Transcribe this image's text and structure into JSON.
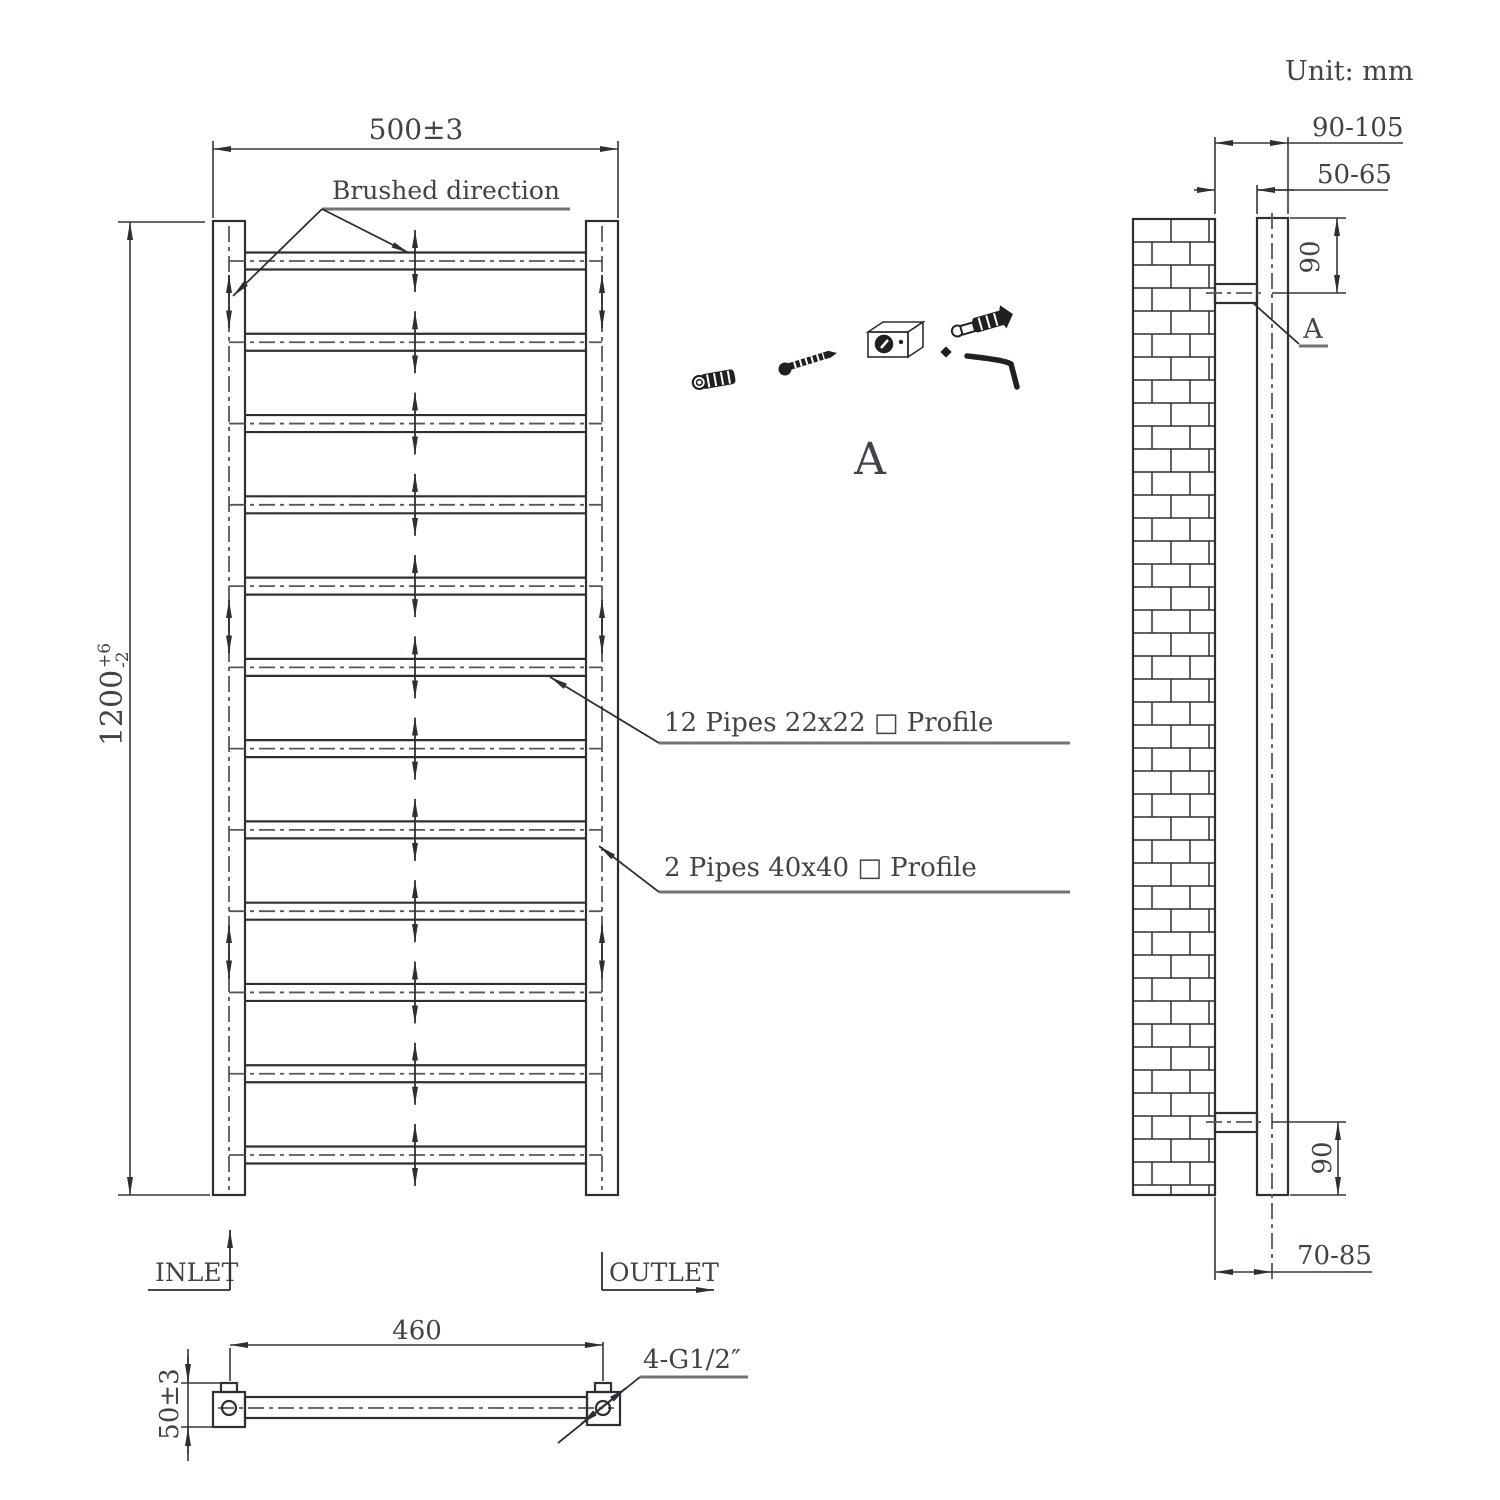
{
  "title": {
    "unit_label": "Unit: mm"
  },
  "front_view": {
    "width_dim": "500±3",
    "height_dim_value": "1200",
    "height_dim_tol_plus": "+6",
    "height_dim_tol_minus": "-2",
    "brushed_direction_label": "Brushed direction",
    "rungs_label": "12 Pipes 22x22 □ Profile",
    "rails_label": "2 Pipes 40x40 □ Profile",
    "inlet_label": "INLET",
    "outlet_label": "OUTLET",
    "rung_count": 12
  },
  "bottom_view": {
    "centers_dim": "460",
    "depth_dim": "50±3",
    "connections_label": "4-G1/2″"
  },
  "side_view": {
    "wall_to_outer_dim": "90-105",
    "wall_to_inner_dim": "50-65",
    "top_bracket_dim": "90",
    "bottom_bracket_dim": "90",
    "wall_to_center_dim": "70-85",
    "detail_marker": "A"
  },
  "detail_a": {
    "label": "A"
  },
  "colors": {
    "line": "#2c2f33",
    "dash": "#54585e",
    "text": "#3f444a",
    "underline": "#6f747a"
  }
}
